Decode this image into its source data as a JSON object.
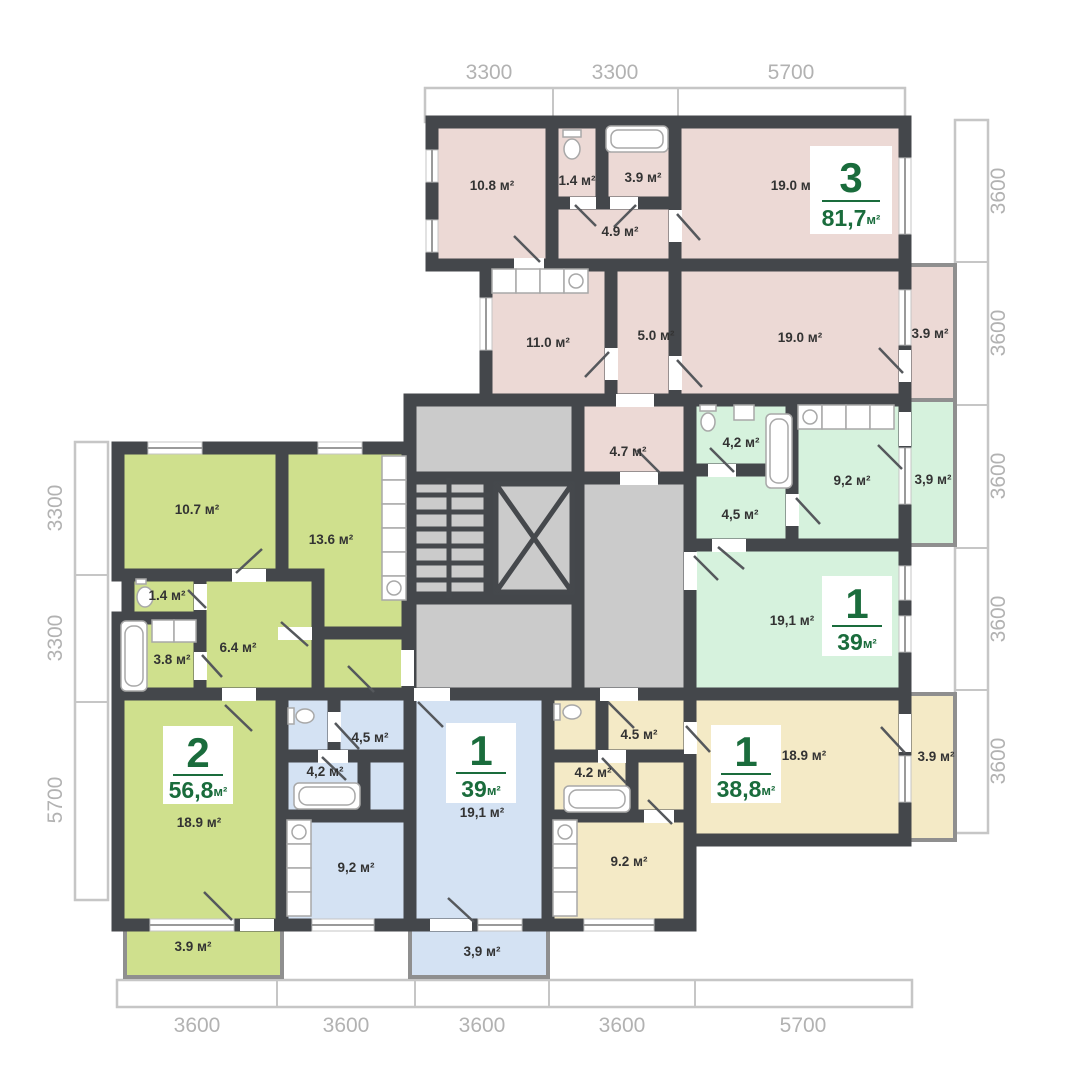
{
  "colors": {
    "wall": "#44474b",
    "pink": "#ecd9d5",
    "mint": "#d6f2dd",
    "lime": "#cfe08d",
    "blue": "#d4e2f3",
    "yellow": "#f4eac6",
    "common": "#cbcbcb",
    "badge_green": "#1a6c3c",
    "label": "#333333",
    "ruler_text": "#b2b2b2"
  },
  "rulers": {
    "top": [
      "3300",
      "3300",
      "5700"
    ],
    "right": [
      "3600",
      "3600",
      "3600",
      "3600",
      "3600"
    ],
    "left": [
      "3300",
      "3300",
      "5700"
    ],
    "bottom": [
      "3600",
      "3600",
      "3600",
      "3600",
      "5700"
    ]
  },
  "apartments": {
    "pink": {
      "badge": {
        "number": "3",
        "area": "81,7",
        "unit": "м²"
      },
      "rooms": [
        "10.8 м²",
        "1.4 м²",
        "3.9 м²",
        "4.9 м²",
        "19.0 м²",
        "11.0 м²",
        "5.0 м²",
        "19.0 м²",
        "3.9 м²",
        "4.7 м²"
      ]
    },
    "mint": {
      "badge": {
        "number": "1",
        "area": "39",
        "unit": "м²"
      },
      "rooms": [
        "4,2 м²",
        "9,2 м²",
        "3,9 м²",
        "4,5 м²",
        "19,1 м²"
      ]
    },
    "lime": {
      "badge": {
        "number": "2",
        "area": "56,8",
        "unit": "м²"
      },
      "rooms": [
        "10.7 м²",
        "13.6 м²",
        "1.4 м²",
        "3.8 м²",
        "6.4 м²",
        "18.9 м²",
        "3.9 м²"
      ]
    },
    "blue": {
      "badge": {
        "number": "1",
        "area": "39",
        "unit": "м²"
      },
      "rooms": [
        "4,5 м²",
        "4,2 м²",
        "9,2 м²",
        "19,1 м²",
        "3,9 м²"
      ]
    },
    "yellow": {
      "badge": {
        "number": "1",
        "area": "38,8",
        "unit": "м²"
      },
      "rooms": [
        "4.5 м²",
        "4.2 м²",
        "9.2 м²",
        "18.9 м²",
        "3.9 м²"
      ]
    }
  }
}
